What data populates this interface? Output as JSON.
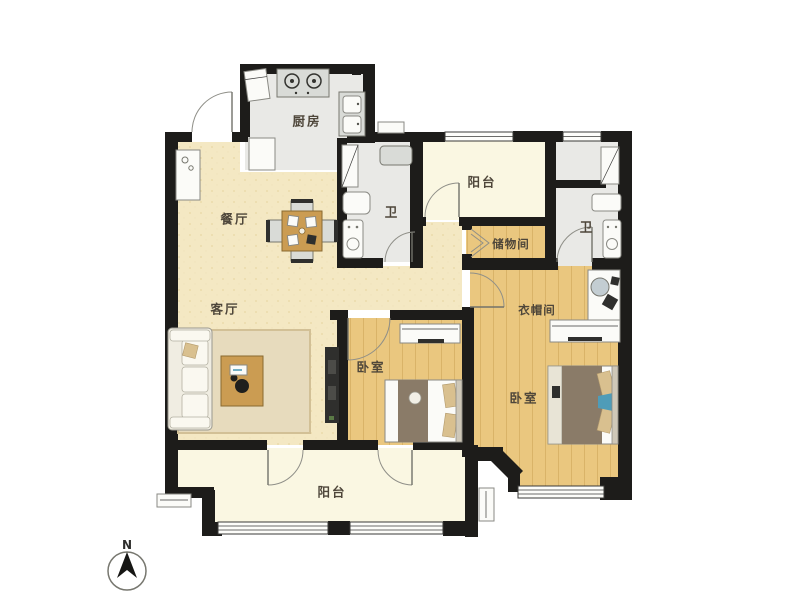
{
  "rooms": {
    "kitchen": {
      "label": "厨房"
    },
    "dining": {
      "label": "餐厅"
    },
    "living": {
      "label": "客厅"
    },
    "balcony_top": {
      "label": "阳台"
    },
    "bath_1": {
      "label": "卫"
    },
    "storage": {
      "label": "储物间"
    },
    "bath_2": {
      "label": "卫"
    },
    "cloakroom": {
      "label": "衣帽间"
    },
    "bedroom_1": {
      "label": "卧室"
    },
    "bedroom_2": {
      "label": "卧室"
    },
    "balcony_bottom": {
      "label": "阳台"
    }
  },
  "compass": {
    "north_label": "N"
  },
  "colors": {
    "wall": "#1d1c1a",
    "floor_warm": "#f4e8c3",
    "floor_wood": "#eac77f",
    "floor_wood_line": "#d9b368",
    "floor_gray": "#e9e9e6",
    "floor_cream": "#faf7e2",
    "rug": "#e7dbbd",
    "wood_furniture": "#cb9c52",
    "door_arc": "#8f8f88",
    "dark_unit": "#2f2f2d",
    "accent_blue": "#4f9cb8",
    "bed_blanket": "#8a7b68",
    "pillow": "#d9c08f"
  }
}
